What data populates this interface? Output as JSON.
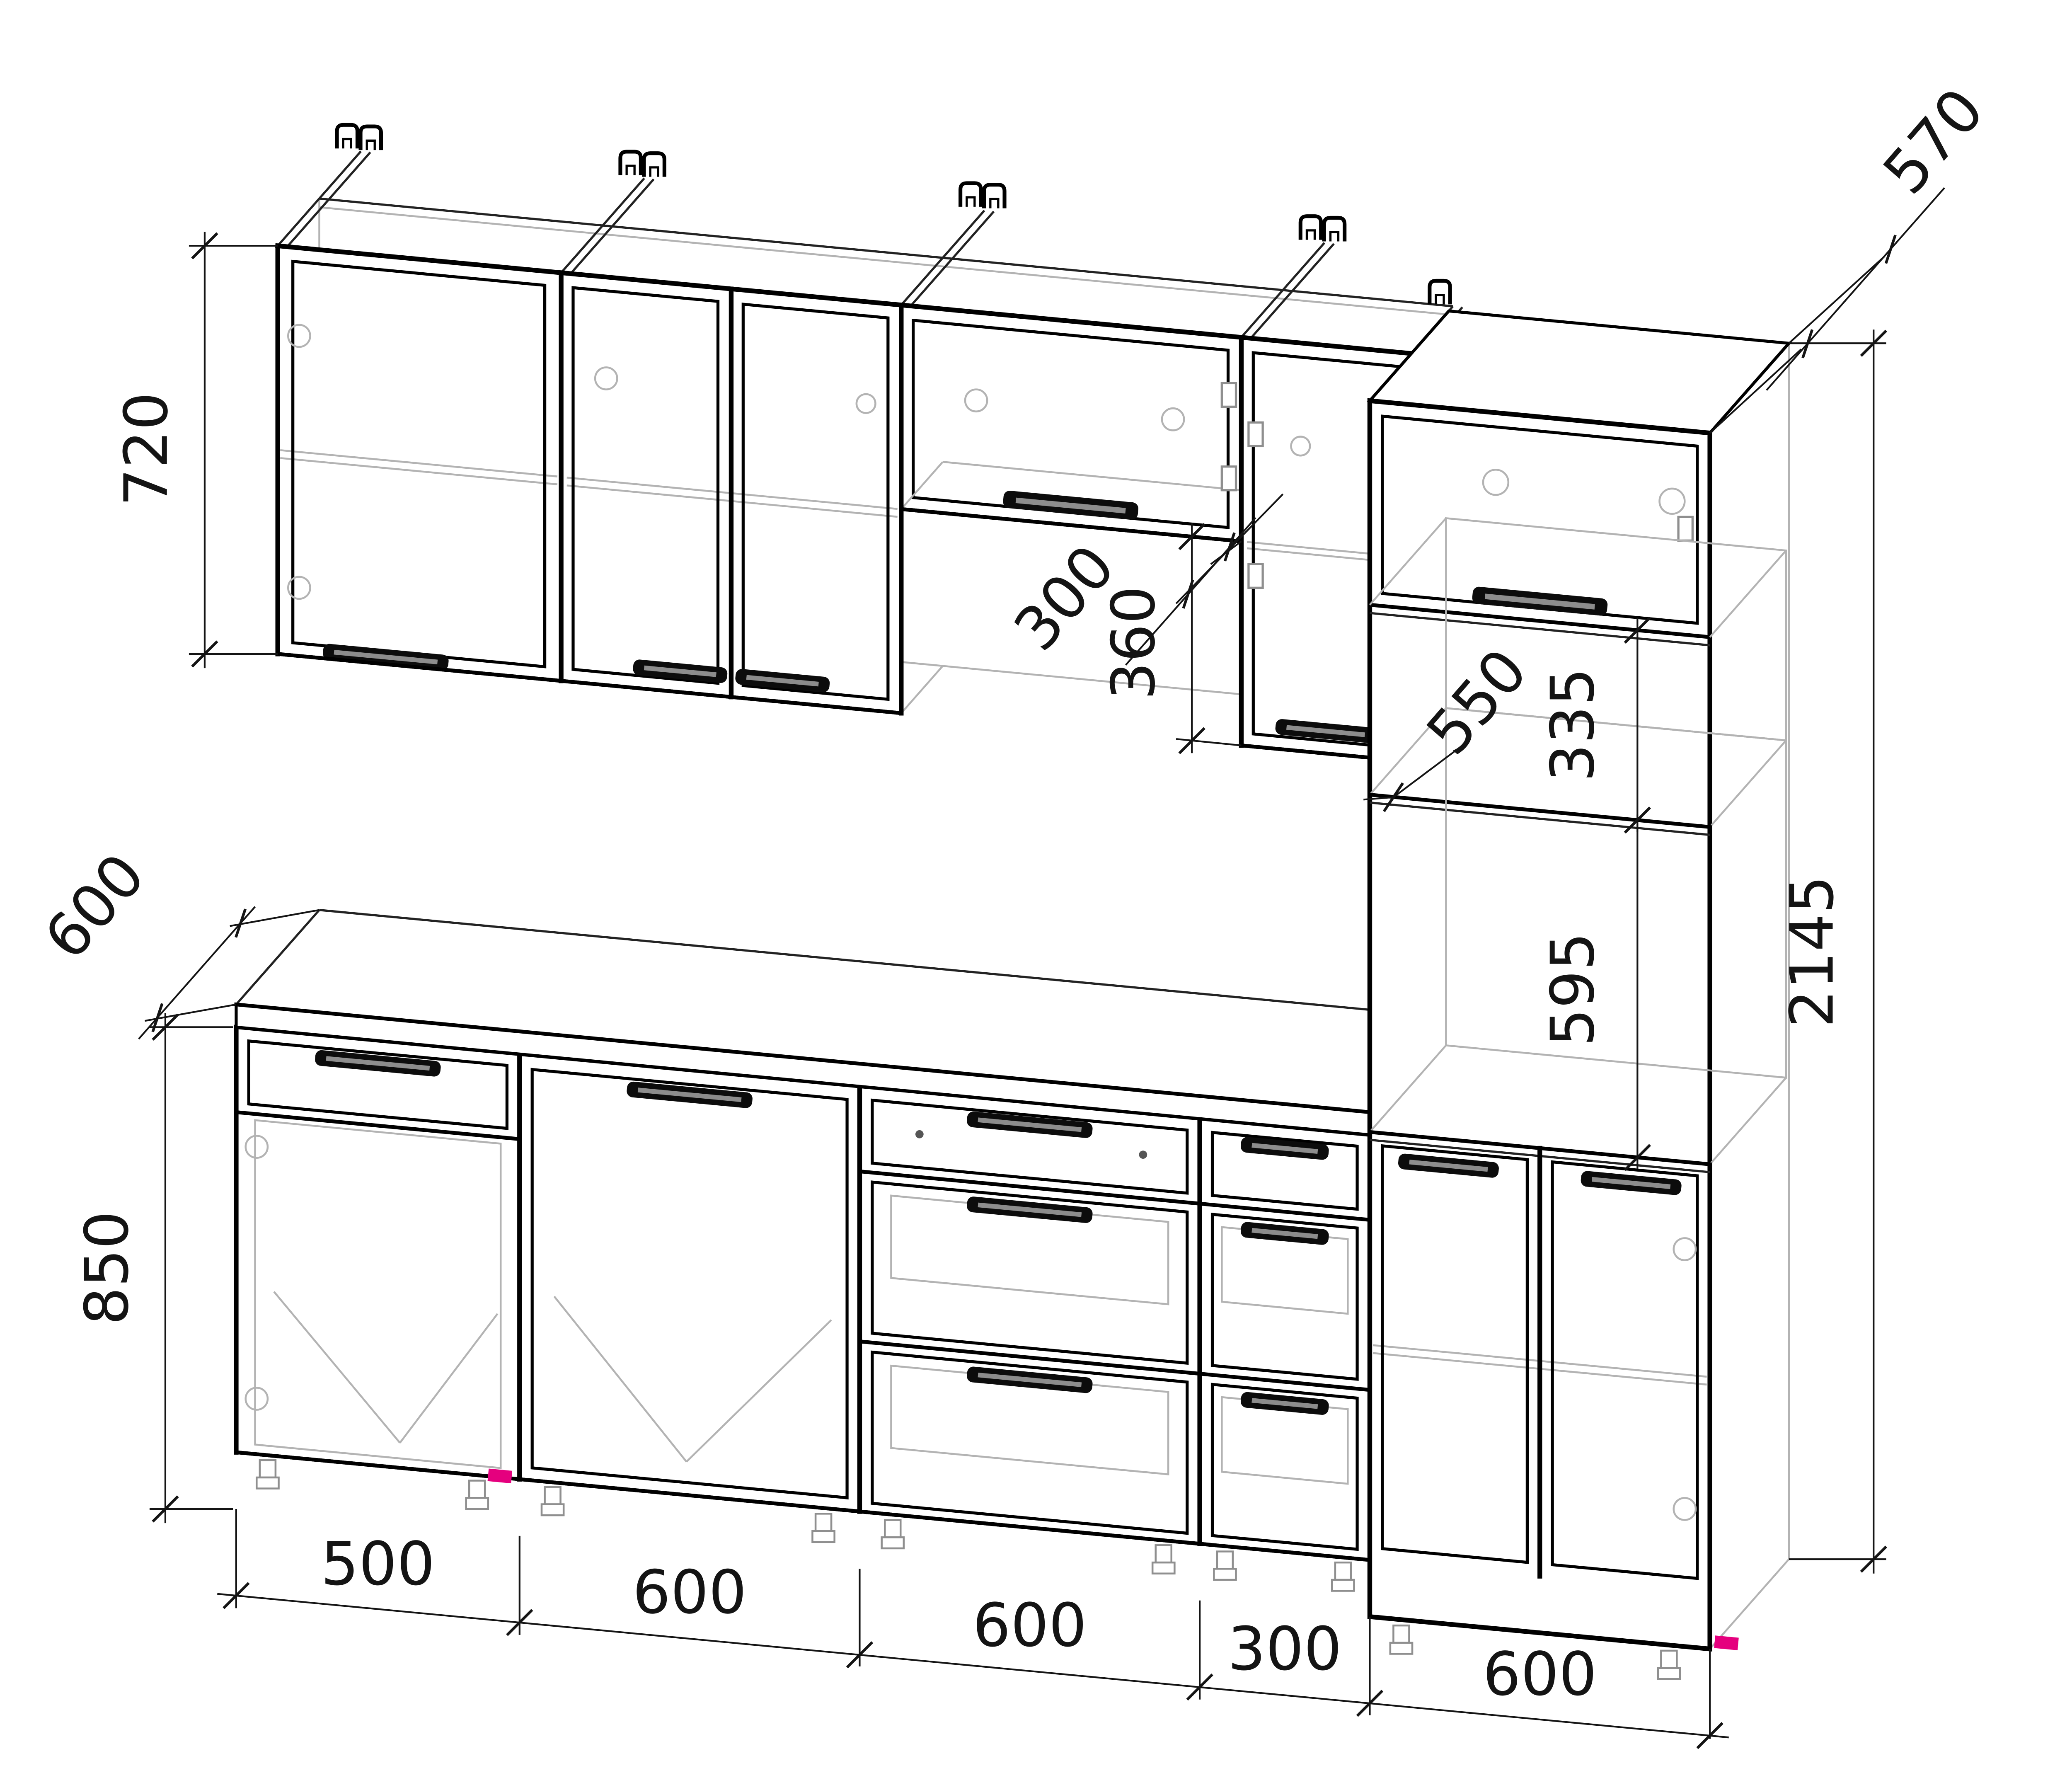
{
  "drawing": {
    "type": "kitchen-cabinet-set-elevation",
    "units": "mm",
    "style": {
      "background": "#ffffff",
      "visible_line_color": "#000000",
      "hidden_line_color": "#b3b3b3",
      "dimension_color": "#141414",
      "accent_color": "#e5007e"
    }
  },
  "dimensions": {
    "wall_cabinet_height": "720",
    "worktop_depth": "600",
    "base_cabinet_height": "850",
    "wall_cabinet_depth": "300",
    "flap_opening_height": "360",
    "tall_niche_height": "335",
    "tall_internal_depth": "550",
    "oven_niche_height": "595",
    "tall_cabinet_height": "2145",
    "tall_cabinet_depth": "570",
    "width_chain": [
      "500",
      "600",
      "600",
      "300",
      "600"
    ]
  }
}
